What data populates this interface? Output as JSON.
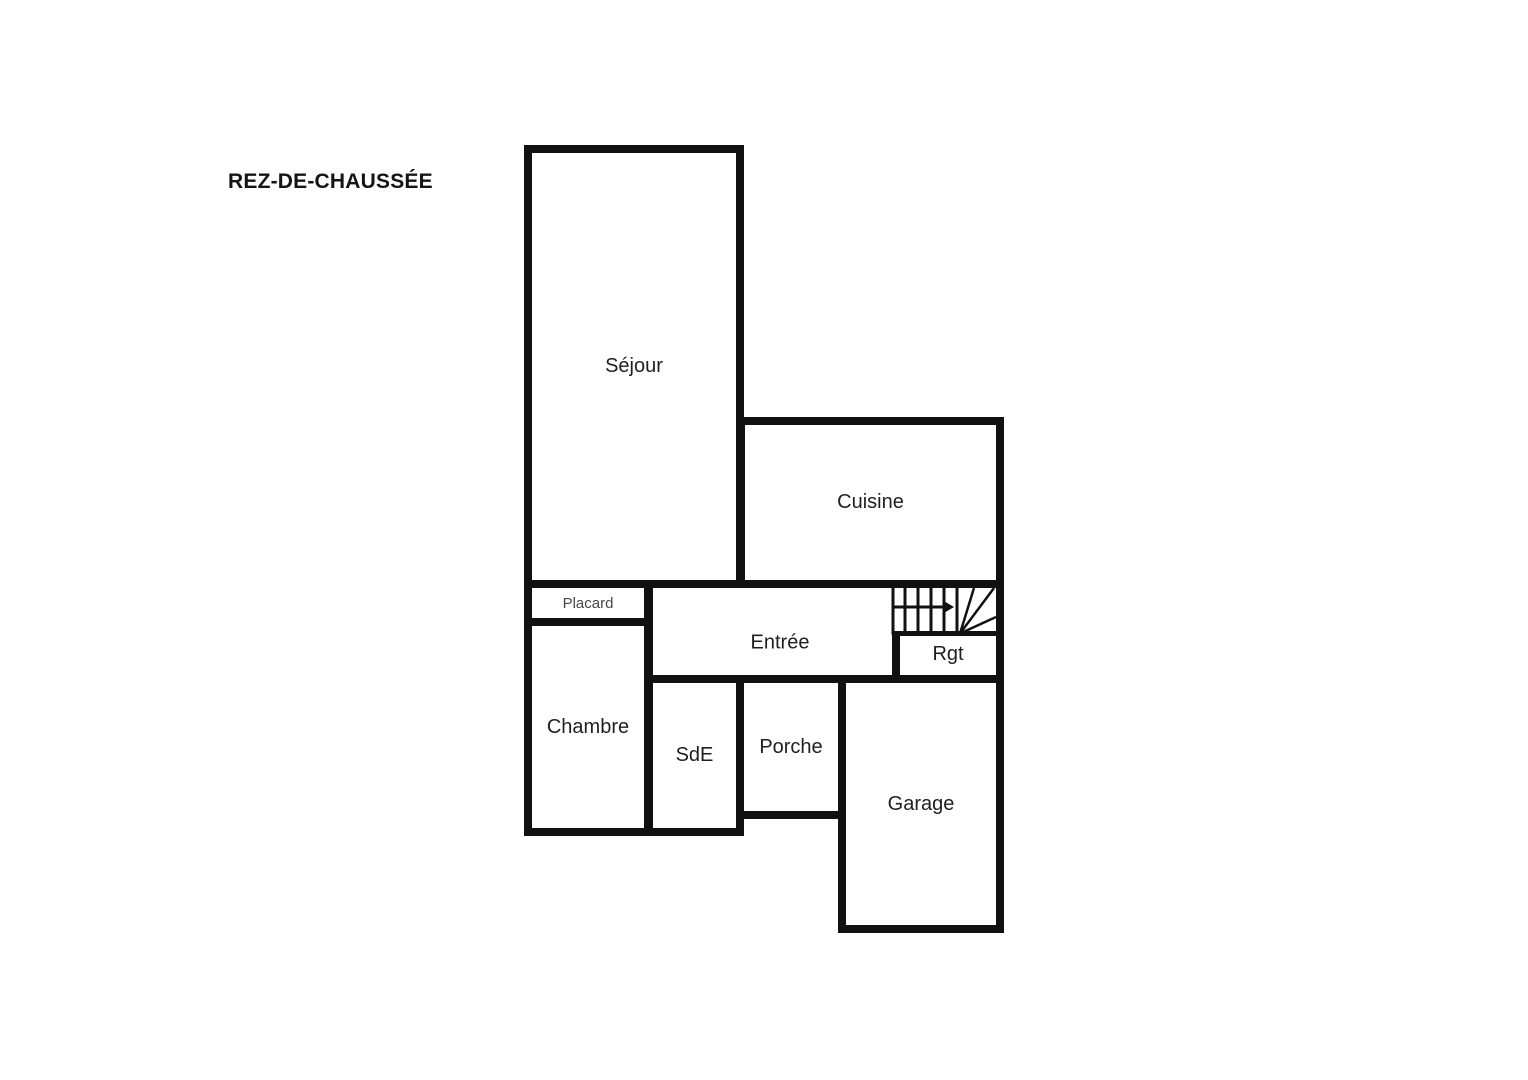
{
  "title": "REZ-DE-CHAUSSÉE",
  "rooms": {
    "sejour": "Séjour",
    "cuisine": "Cuisine",
    "placard": "Placard",
    "entree": "Entrée",
    "rgt": "Rgt",
    "chambre": "Chambre",
    "sde": "SdE",
    "porche": "Porche",
    "garage": "Garage"
  },
  "staircase": {
    "arrow_direction": "right",
    "straight_treads": 6,
    "winder_fan_lines": 3
  },
  "colors": {
    "wall": "#111111",
    "room_text": "#1f1f1f",
    "placard_text": "#474747",
    "title_text": "#141414",
    "background": "#ffffff"
  }
}
